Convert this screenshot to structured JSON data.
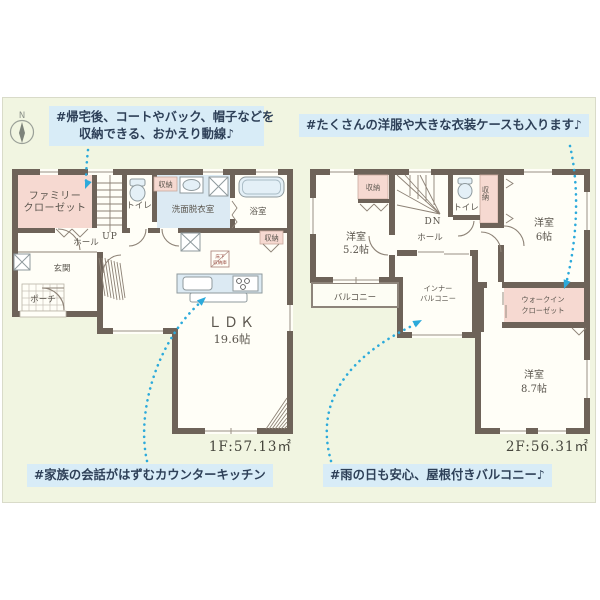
{
  "colors": {
    "panel_bg": "#f1f5e1",
    "wall": "#6e6359",
    "closet_pink": "#f6d9d1",
    "fixture_blue": "#dceaf3",
    "note_bg": "#d8ecf7",
    "note_text": "#2e4058",
    "accent_cyan": "#2caadb"
  },
  "compass": {
    "north_label": "N"
  },
  "annotations": {
    "entry_flow": {
      "line1": "#帰宅後、コートやバック、帽子などを",
      "line2": "収納できる、おかえり動線♪"
    },
    "closet": {
      "text": "#たくさんの洋服や大きな衣装ケースも入ります♪"
    },
    "kitchen": {
      "text": "#家族の会話がはずむカウンターキッチン"
    },
    "balcony": {
      "text": "#雨の日も安心、屋根付きバルコニー♪"
    }
  },
  "floor1": {
    "area_label": "1F:57.13㎡",
    "rooms": {
      "family_closet_line1": "ファミリー",
      "family_closet_line2": "クローゼット",
      "toilet": "トイレ",
      "storage_top": "収納",
      "washroom": "洗面脱衣室",
      "bath": "浴室",
      "hall": "ホール",
      "up": "UP",
      "entrance": "玄関",
      "porch": "ポーチ",
      "storage_ldk": "収納",
      "ldk_line1": "ＬＤＫ",
      "ldk_line2": "19.6帖",
      "underfloor_line1": "床下",
      "underfloor_line2": "収納庫"
    }
  },
  "floor2": {
    "area_label": "2F:56.31㎡",
    "rooms": {
      "storage_west": "収納",
      "dn": "DN",
      "toilet": "トイレ",
      "storage_east": "収納",
      "hall": "ホール",
      "west_room_line1": "洋室",
      "west_room_line2": "5.2帖",
      "east_room_line1": "洋室",
      "east_room_line2": "6帖",
      "south_room_line1": "洋室",
      "south_room_line2": "8.7帖",
      "balcony": "バルコニー",
      "inner_balcony_line1": "インナー",
      "inner_balcony_line2": "バルコニー",
      "wic_line1": "ウォークイン",
      "wic_line2": "クローゼット"
    }
  }
}
